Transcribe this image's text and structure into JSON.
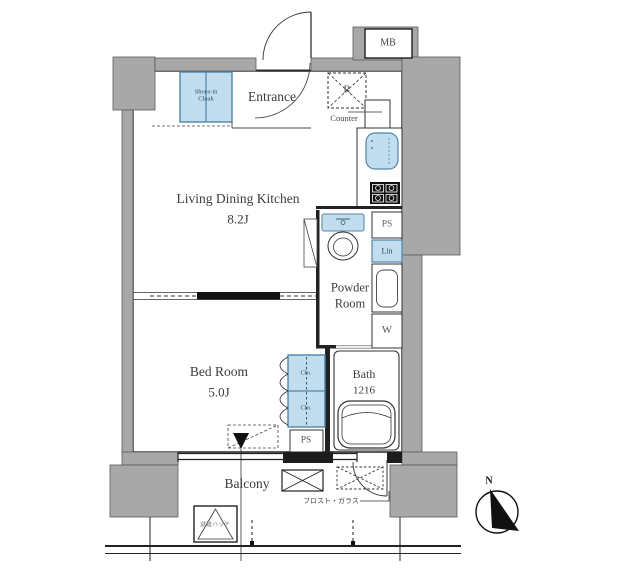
{
  "colors": {
    "wall_gray": "#a8a8a8",
    "fixture_blue": "#c2ddee",
    "blue_border": "#4f86a8",
    "line": "#2b2b2b",
    "label_dark": "#3c3c3c",
    "label_gray": "#5a5a5a"
  },
  "rooms": {
    "ldk": {
      "name": "Living Dining Kitchen",
      "size": "8.2J"
    },
    "bedroom": {
      "name": "Bed Room",
      "size": "5.0J"
    },
    "bath": {
      "name": "Bath",
      "size": "1216"
    },
    "powder_room": {
      "line1": "Powder",
      "line2": "Room"
    },
    "entrance": {
      "name": "Entrance"
    },
    "balcony": {
      "name": "Balcony"
    }
  },
  "fixtures": {
    "meter_box": "MB",
    "shoes_closet": {
      "line1": "Shoes-in",
      "line2": "Cloak"
    },
    "refrigerator": "R",
    "counter": "Counter",
    "pipe_space_top": "PS",
    "linen": "Lin",
    "washer": "W",
    "closet_upper": "Clo.",
    "closet_lower": "Clo.",
    "pipe_space_bottom": "PS"
  },
  "annotations": {
    "frosted_glass": "フロスト・ガラス",
    "evacuation_hatch": "避難ハッチ",
    "compass_north": "N"
  }
}
